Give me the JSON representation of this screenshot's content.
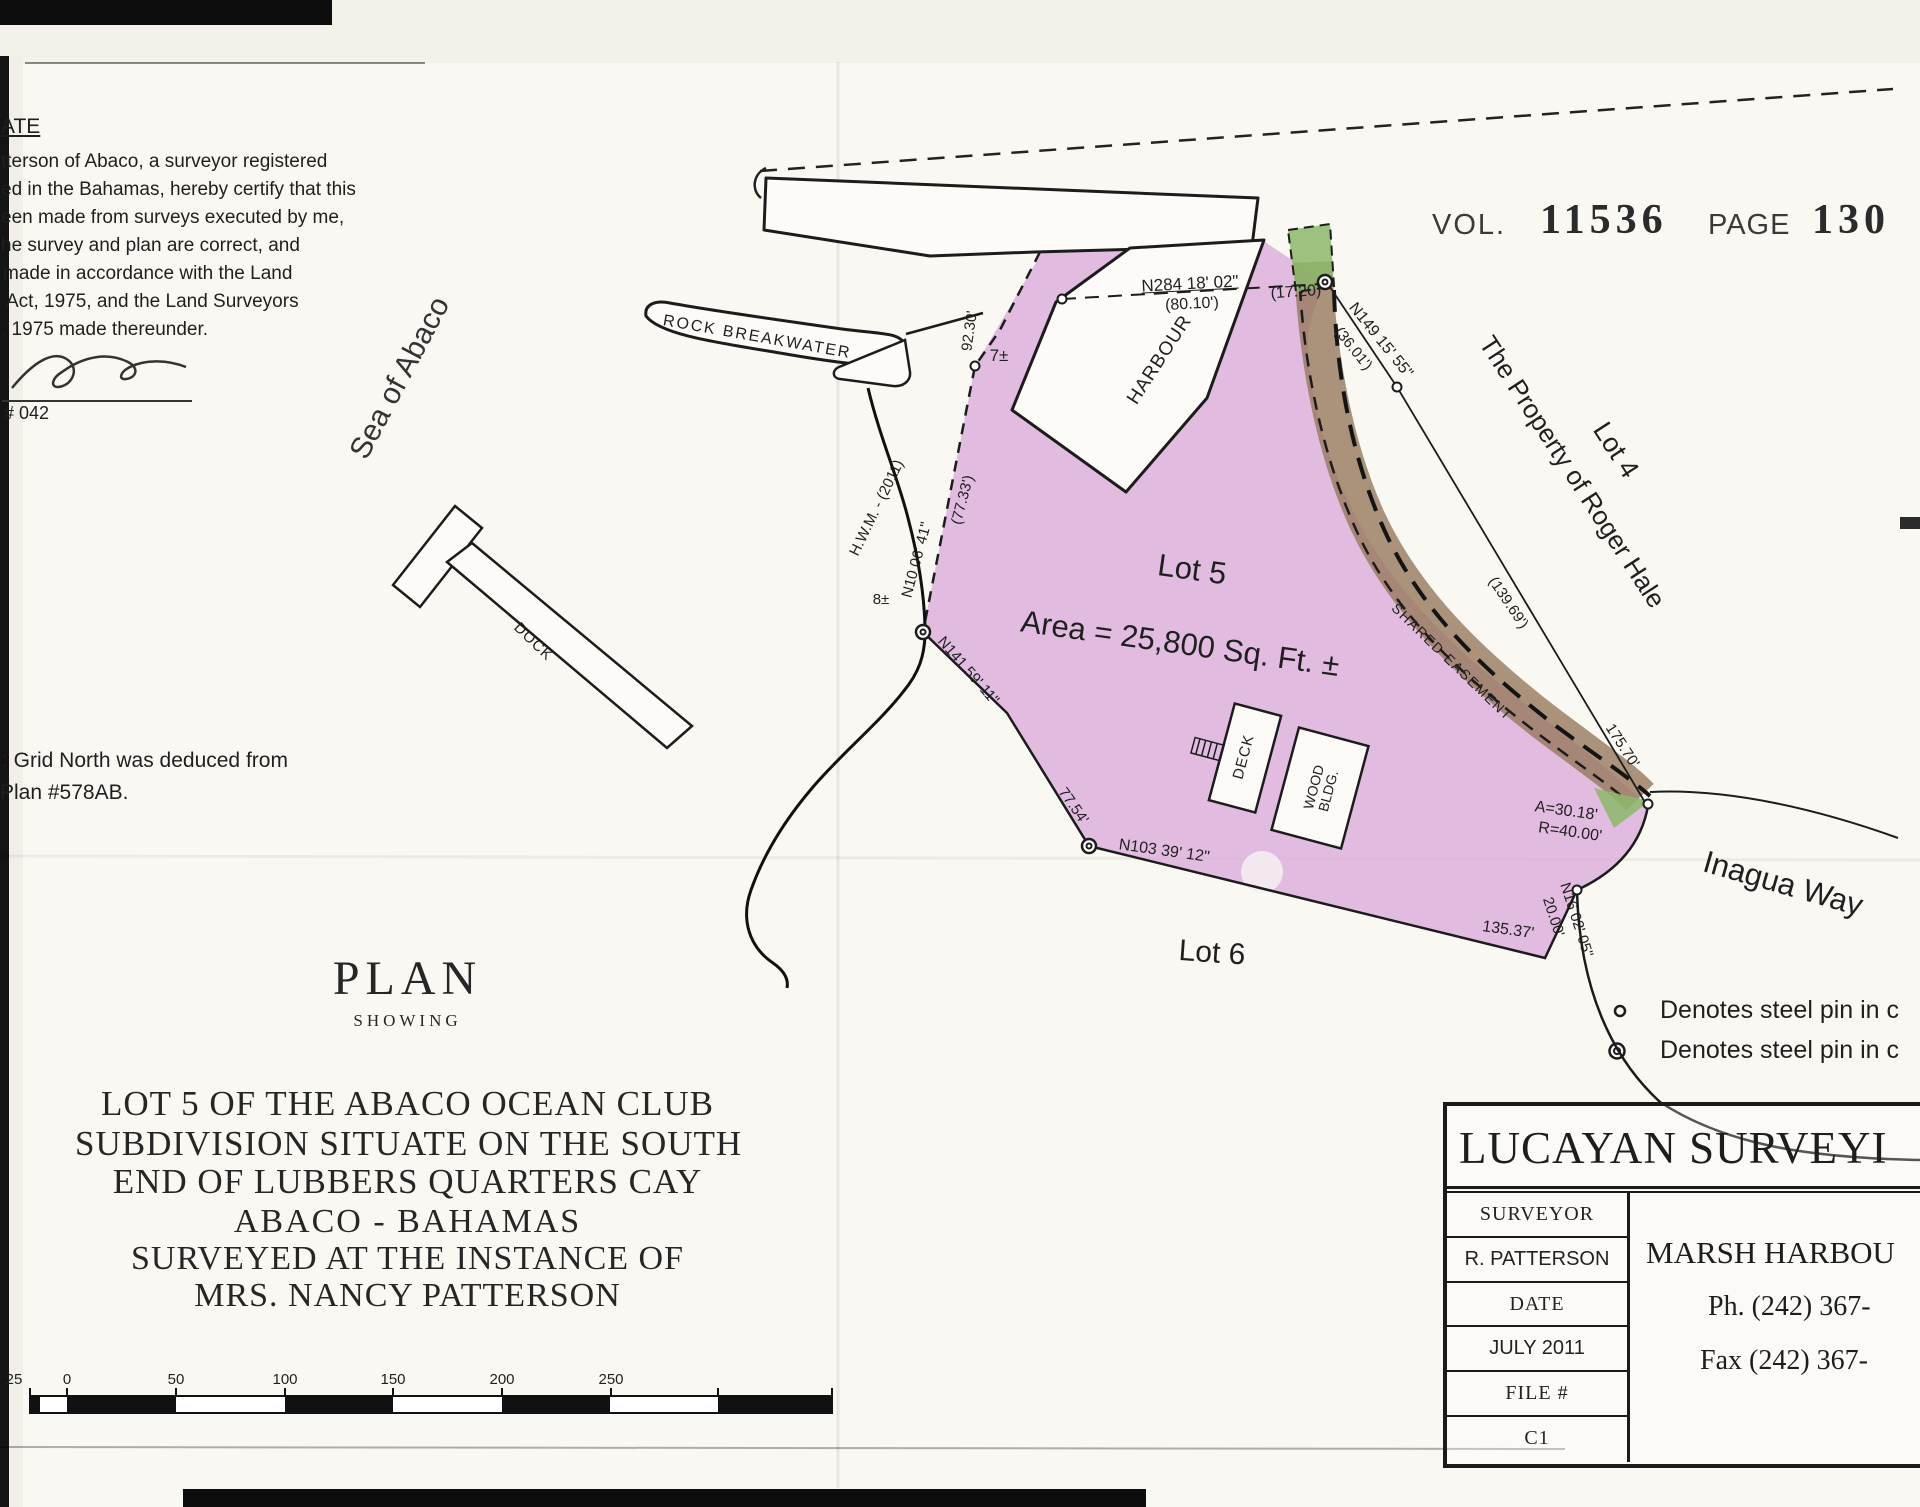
{
  "certificate": {
    "heading": "ATE",
    "lines": [
      "tterson of Abaco, a surveyor registered",
      "ed in the Bahamas, hereby certify that this",
      "een made from surveys executed by me,",
      "he survey and plan are correct, and",
      "made in accordance with the Land",
      "Act, 1975, and the Land Surveyors",
      ", 1975 made thereunder."
    ],
    "number": "# 042"
  },
  "stamp": {
    "vol": "VOL.",
    "vol_no": "11536",
    "page": "PAGE",
    "page_no": "130"
  },
  "note": {
    "l1": ": Grid North was deduced from",
    "l2": "Plan #578AB."
  },
  "map": {
    "sea": "Sea of Abaco",
    "breakwater": "ROCK BREAKWATER",
    "dock": "DOCK",
    "harbour": "HARBOUR",
    "hwm": "H.W.M. - (2011)",
    "lot5": "Lot 5",
    "area": "Area = 25,800 Sq. Ft. ±",
    "lot6": "Lot 6",
    "lot4": "Lot 4",
    "owner": "The Property of Roger Hale",
    "road": "Inagua Way",
    "shared": "SHARED EASEMENT",
    "deck": "DECK",
    "wood1": "WOOD",
    "wood2": "BLDG."
  },
  "dims": {
    "n284": "N284 18' 02\"",
    "d8010": "(80.10')",
    "d1720": "(17.20)",
    "n149": "N149 15' 55\"",
    "d3601": "(36.01')",
    "d13969": "(139.69')",
    "d17570": "175.70'",
    "arc": "A=30.18'",
    "rad": "R=40.00'",
    "d13537": "135.37'",
    "d2000": "20.00'",
    "n16": "N16 02' 05\"",
    "n103": "N103 39' 12\"",
    "d7754": "77.54'",
    "n141": "N141 59' 11\"",
    "n10": "N10 06' 41\"",
    "d7733": "(77.33')",
    "d9230": "92.30'",
    "p7": "7±",
    "p8": "8±"
  },
  "legend": {
    "pin1": "Denotes steel pin in c",
    "pin2": "Denotes steel pin in c"
  },
  "title": {
    "plan": "PLAN",
    "showing": "SHOWING",
    "l1": "LOT 5 OF THE ABACO OCEAN CLUB",
    "l2": "SUBDIVISION SITUATE ON THE SOUTH",
    "l3": "END OF LUBBERS QUARTERS CAY",
    "l4": "ABACO - BAHAMAS",
    "l5": "SURVEYED AT THE INSTANCE OF",
    "l6": "MRS. NANCY PATTERSON"
  },
  "scalebar": {
    "ticks": [
      "25",
      "0",
      "50",
      "100",
      "150",
      "200",
      "250"
    ]
  },
  "titleblock": {
    "company": "LUCAYAN SURVEYI",
    "r1": "SURVEYOR",
    "r2": "R. PATTERSON",
    "r3": "DATE",
    "r4": "JULY 2011",
    "r5": "FILE #",
    "r6": "C1",
    "city": "MARSH HARBOU",
    "ph": "Ph. (242) 367-",
    "fax": "Fax (242) 367-"
  },
  "colors": {
    "lot": "#d8a5d8",
    "easement": "#96785d",
    "green": "#8cb86a",
    "ink": "#1c1c1c"
  }
}
